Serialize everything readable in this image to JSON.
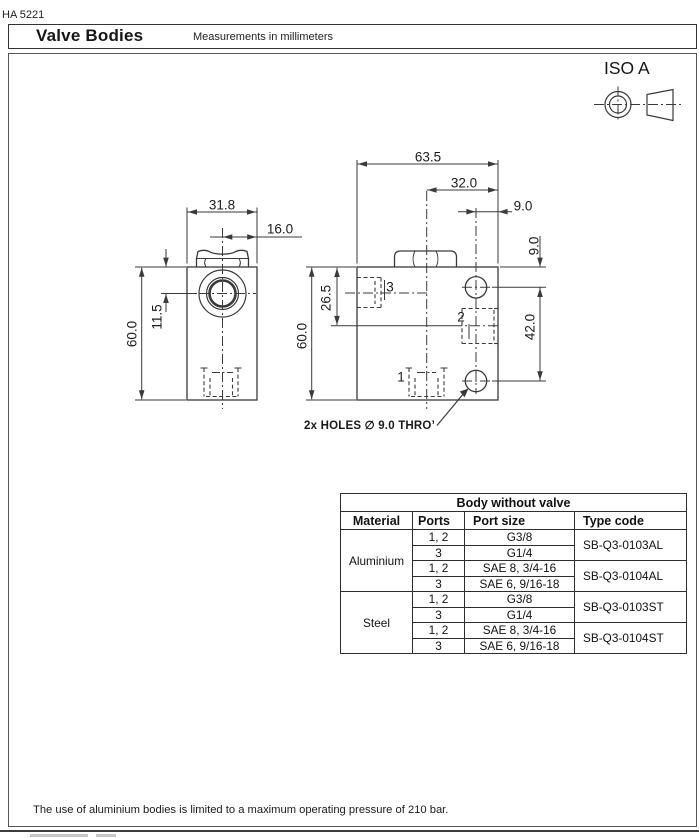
{
  "page": {
    "doc_code": "HA 5221"
  },
  "header": {
    "title": "Valve Bodies",
    "subtitle": "Measurements in millimeters"
  },
  "projection": {
    "label": "ISO A"
  },
  "drawing": {
    "front_view": {
      "width_dim": "31.8",
      "cavity_offset_dim": "16.0",
      "port_center_dim": "11.5",
      "height_dim": "60.0"
    },
    "side_view": {
      "width_dim": "63.5",
      "cavity_offset_dim": "32.0",
      "hole_edge_dim": "9.0",
      "hole_top_dim": "9.0",
      "port3_center_dim": "26.5",
      "height_dim": "60.0",
      "hole_spacing_dim": "42.0",
      "port1_label": "1",
      "port2_label": "2",
      "port3_label": "3"
    },
    "holes_note": "2x HOLES ∅ 9.0 THRO’"
  },
  "table": {
    "title": "Body without valve",
    "columns": [
      "Material",
      "Ports",
      "Port size",
      "Type code"
    ],
    "rows": [
      {
        "material": "Aluminium",
        "ports": "1, 2",
        "size": "G3/8",
        "code": "SB-Q3-0103AL"
      },
      {
        "ports": "3",
        "size": "G1/4"
      },
      {
        "ports": "1, 2",
        "size": "SAE 8, 3/4-16",
        "code": "SB-Q3-0104AL"
      },
      {
        "ports": "3",
        "size": "SAE 6, 9/16-18"
      },
      {
        "material": "Steel",
        "ports": "1, 2",
        "size": "G3/8",
        "code": "SB-Q3-0103ST"
      },
      {
        "ports": "3",
        "size": "G1/4"
      },
      {
        "ports": "1, 2",
        "size": "SAE 8, 3/4-16",
        "code": "SB-Q3-0104ST"
      },
      {
        "ports": "3",
        "size": "SAE 6, 9/16-18"
      }
    ]
  },
  "footer": {
    "note": "The use of aluminium bodies is limited to a maximum operating pressure of 210 bar."
  },
  "colors": {
    "line": "#3a3a3a",
    "border": "#333333",
    "text": "#111111"
  }
}
